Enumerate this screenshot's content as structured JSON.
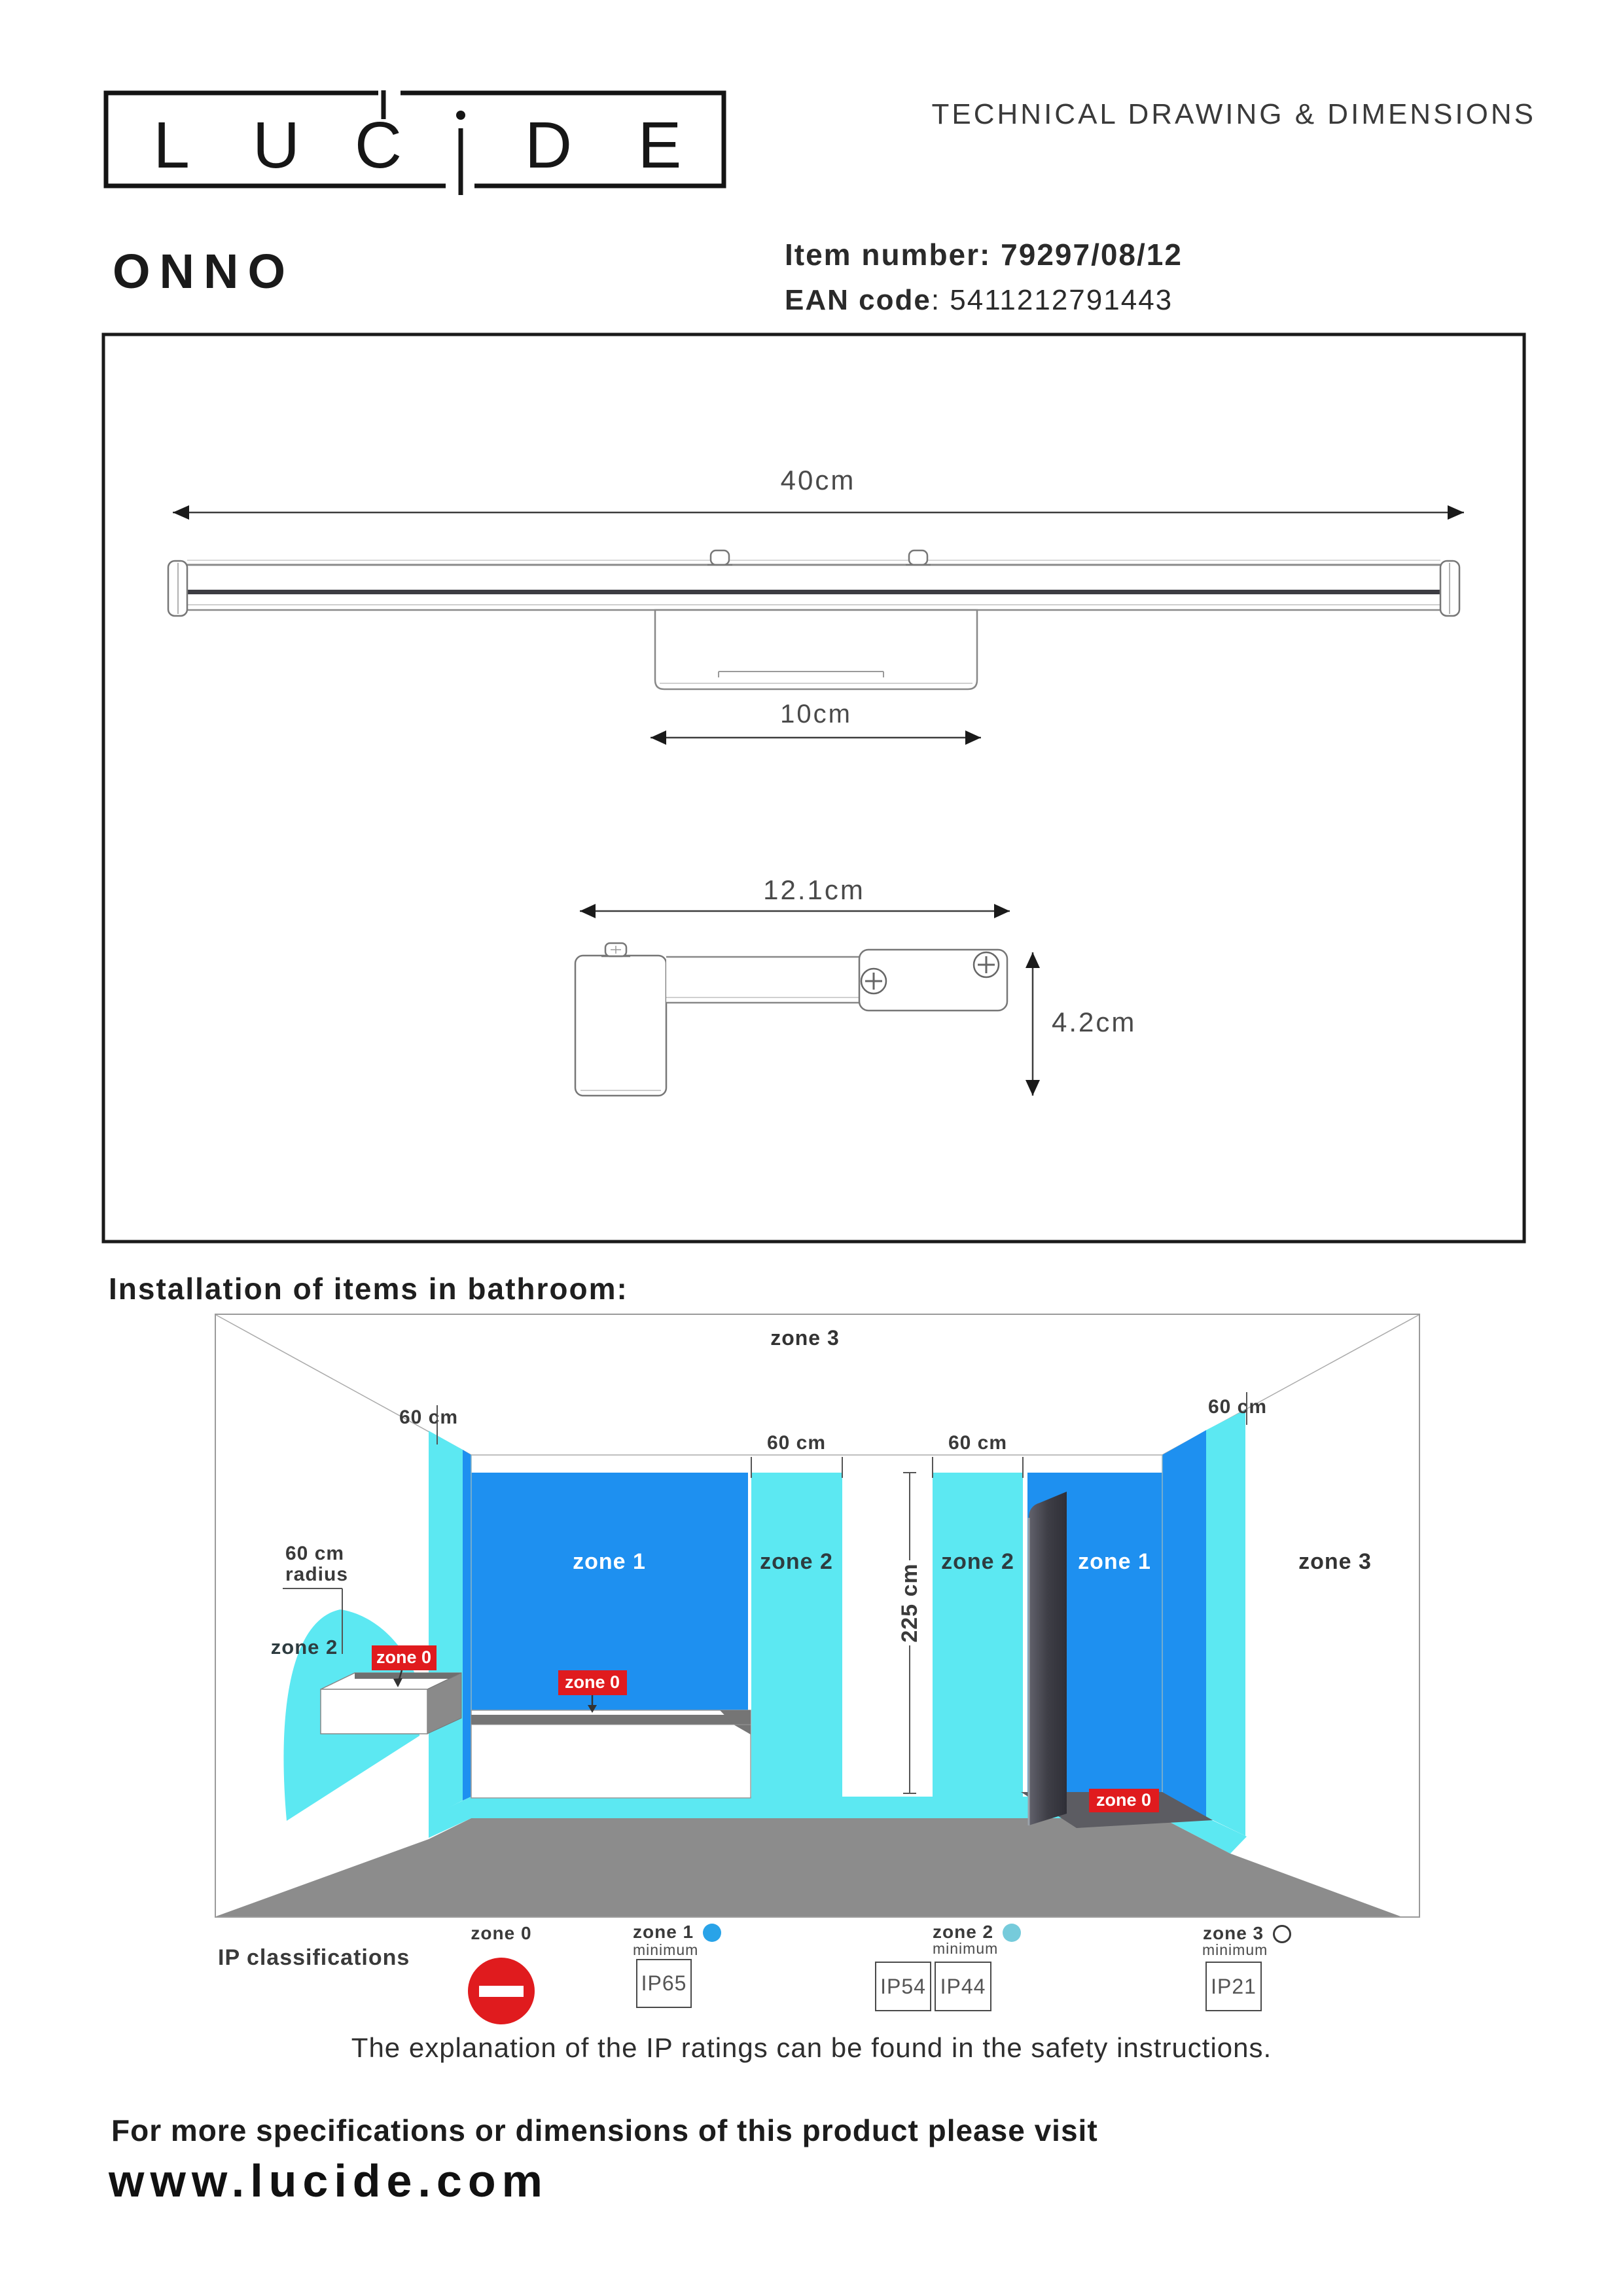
{
  "header": {
    "logo_letters": [
      "L",
      "U",
      "C",
      "D",
      "E"
    ],
    "doc_title": "TECHNICAL DRAWING & DIMENSIONS",
    "product_name": "ONNO",
    "item_label": "Item number:",
    "item_value": "79297/08/12",
    "ean_label": "EAN code",
    "ean_colon": ": ",
    "ean_value": "5411212791443"
  },
  "technical_drawing": {
    "front_width": "40cm",
    "bracket_width": "10cm",
    "side_depth": "12.1cm",
    "side_height": "4.2cm"
  },
  "bathroom": {
    "heading": "Installation of items in bathroom:",
    "sixty_cm": "60 cm",
    "radius_line1": "60 cm",
    "radius_line2": "radius",
    "height_dim": "225 cm",
    "zone0": "zone 0",
    "zone1": "zone 1",
    "zone2": "zone 2",
    "zone3": "zone 3"
  },
  "ip": {
    "heading": "IP classifications",
    "minimum": "minimum",
    "zone0_label": "zone 0",
    "zone1_label": "zone 1",
    "zone2_label": "zone 2",
    "zone3_label": "zone 3",
    "zone1_ratings": [
      "IP65"
    ],
    "zone2_ratings": [
      "IP54",
      "IP44"
    ],
    "zone3_ratings": [
      "IP21"
    ],
    "explanation": "The explanation of the IP ratings can be found in the safety instructions."
  },
  "footer": {
    "line1": "For more specifications or dimensions of this product please visit",
    "website": "www.lucide.com"
  },
  "colors": {
    "zone1_blue": "#1E90F0",
    "zone2_cyan": "#5CE8F2",
    "zone0_red": "#E01B1E",
    "floor_gray": "#8C8C8C",
    "panel_dark": "#3E3E46",
    "zone1_dot": "#29A3E8",
    "zone2_dot": "#76CBDB"
  }
}
